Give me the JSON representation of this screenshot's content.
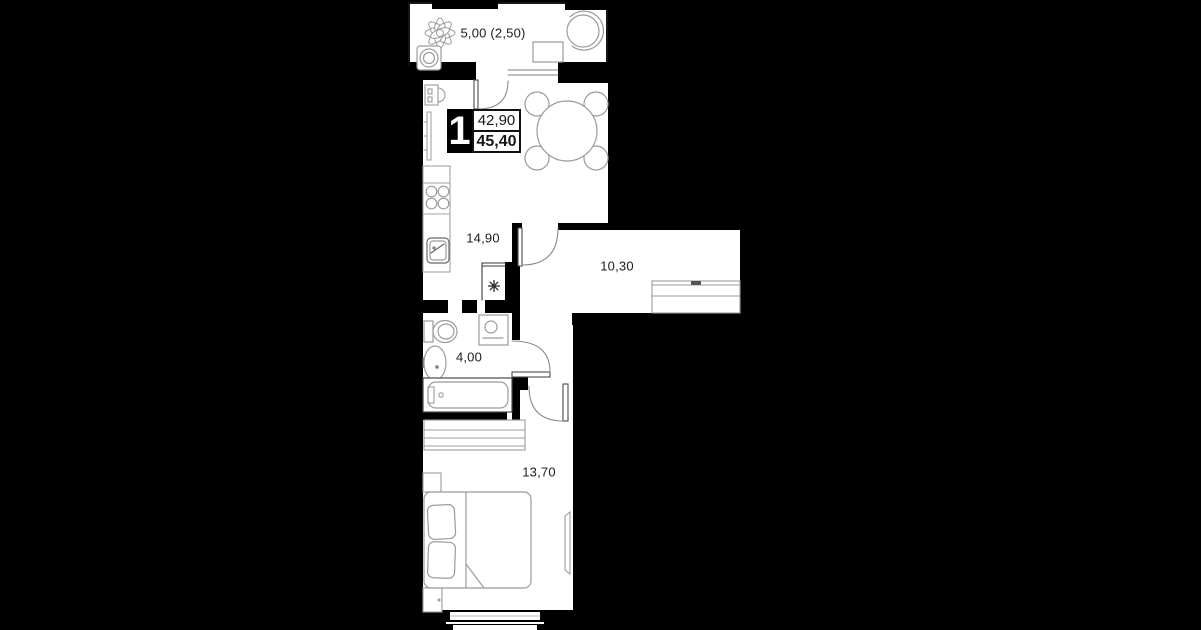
{
  "plan": {
    "apartment_badge": {
      "number": "1",
      "area_top": "42,90",
      "area_bottom": "45,40"
    },
    "rooms": {
      "balcony": {
        "label": "5,00 (2,50)",
        "furniture": [
          "plant-icon",
          "armchair-icon",
          "table-icon",
          "stool-icon"
        ]
      },
      "kitchen_living": {
        "label": "14,90",
        "furniture": [
          "electric-panel-icon",
          "radiator-icon",
          "counter-icon",
          "stove-icon",
          "kitchen-sink-icon",
          "dining-table-icon",
          "chair-icon"
        ]
      },
      "hallway": {
        "label": "10,30",
        "furniture": [
          "wardrobe-icon"
        ]
      },
      "bathroom": {
        "label": "4,00",
        "furniture": [
          "toilet-icon",
          "washing-machine-icon",
          "sink-icon",
          "bathtub-icon"
        ]
      },
      "bedroom": {
        "label": "13,70",
        "furniture": [
          "wardrobe-icon",
          "bed-icon",
          "pillow-icon",
          "nightstand-icon",
          "tv-icon",
          "window-icon"
        ]
      }
    },
    "symbols": {
      "vent": "✳"
    },
    "colors": {
      "background": "#000000",
      "wall": "#000000",
      "floor": "#ffffff",
      "furniture_stroke": "#a2a2a2",
      "door_stroke": "#8a8a8a",
      "frame_stroke": "#4a4a4a",
      "text": "#1d1d1f"
    }
  }
}
